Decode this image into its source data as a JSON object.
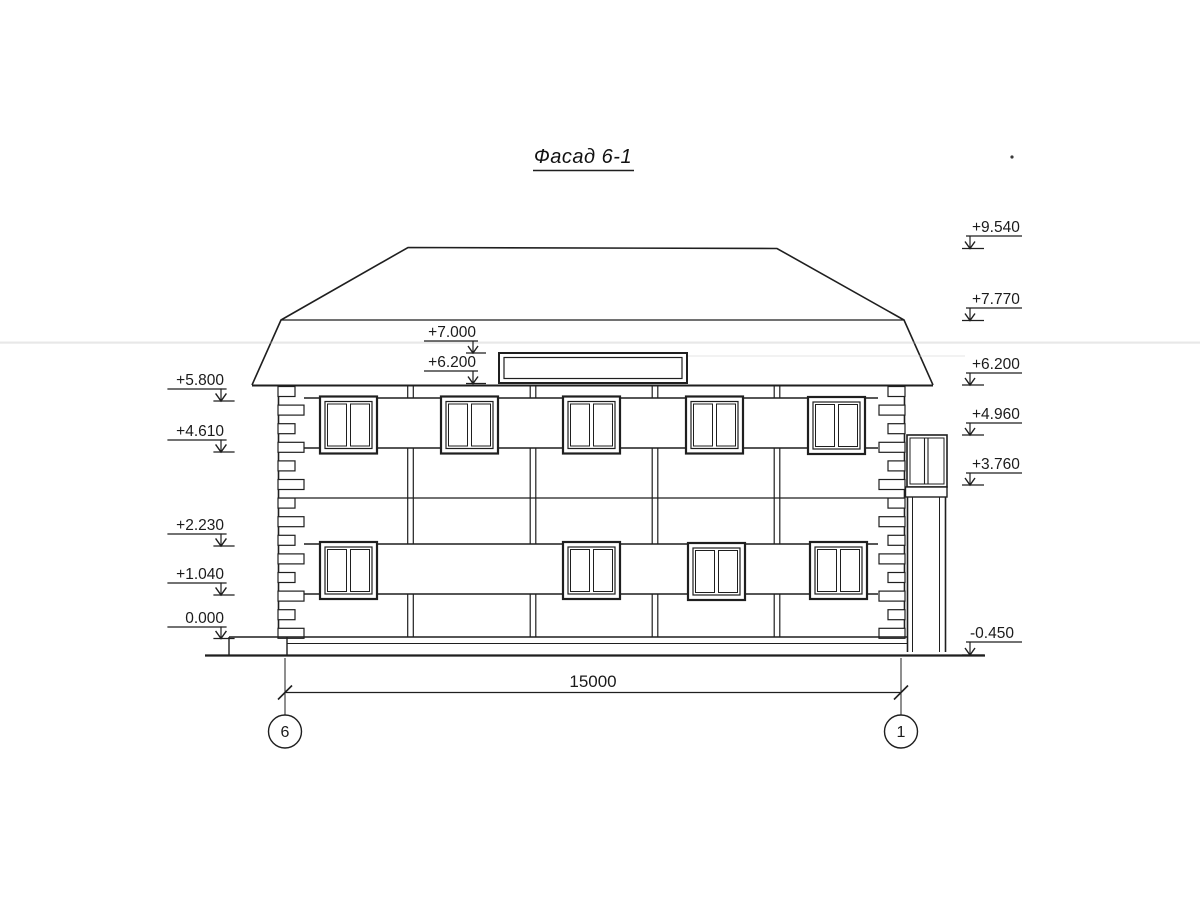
{
  "title": "Фасад 6-1",
  "line_color": "#1f1f1f",
  "background_color": "#ffffff",
  "marks_left": [
    "+5.800",
    "+4.610",
    "+2.230",
    "+1.040",
    "0.000"
  ],
  "marks_right": [
    "+9.540",
    "+7.770",
    "+6.200",
    "+4.960",
    "+3.760",
    "-0.450"
  ],
  "marks_center": [
    "+7.000",
    "+6.200"
  ],
  "dimension": {
    "total_width": "15000"
  },
  "axes": {
    "left": "6",
    "right": "1"
  }
}
